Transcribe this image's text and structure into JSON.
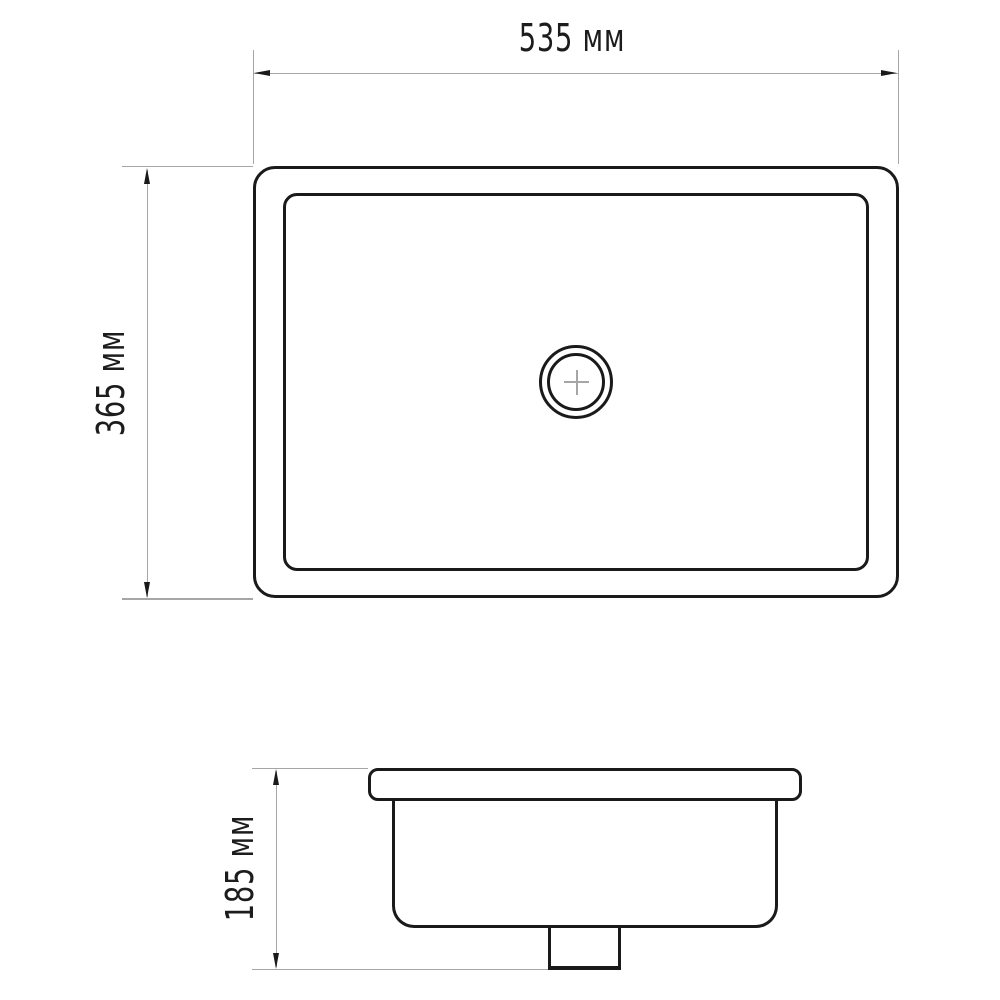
{
  "drawing": {
    "dimensions": {
      "width": {
        "label": "535 мм",
        "value": 535,
        "unit": "мм"
      },
      "height": {
        "label": "365 мм",
        "value": 365,
        "unit": "мм"
      },
      "depth": {
        "label": "185 мм",
        "value": 185,
        "unit": "мм"
      }
    },
    "icons": {
      "drain_center_mark": "crosshair-plus"
    },
    "colors": {
      "line": "#1a1a1a",
      "dimension": "#a6a6a6",
      "background": "#ffffff",
      "text": "#1c1c1c"
    }
  }
}
